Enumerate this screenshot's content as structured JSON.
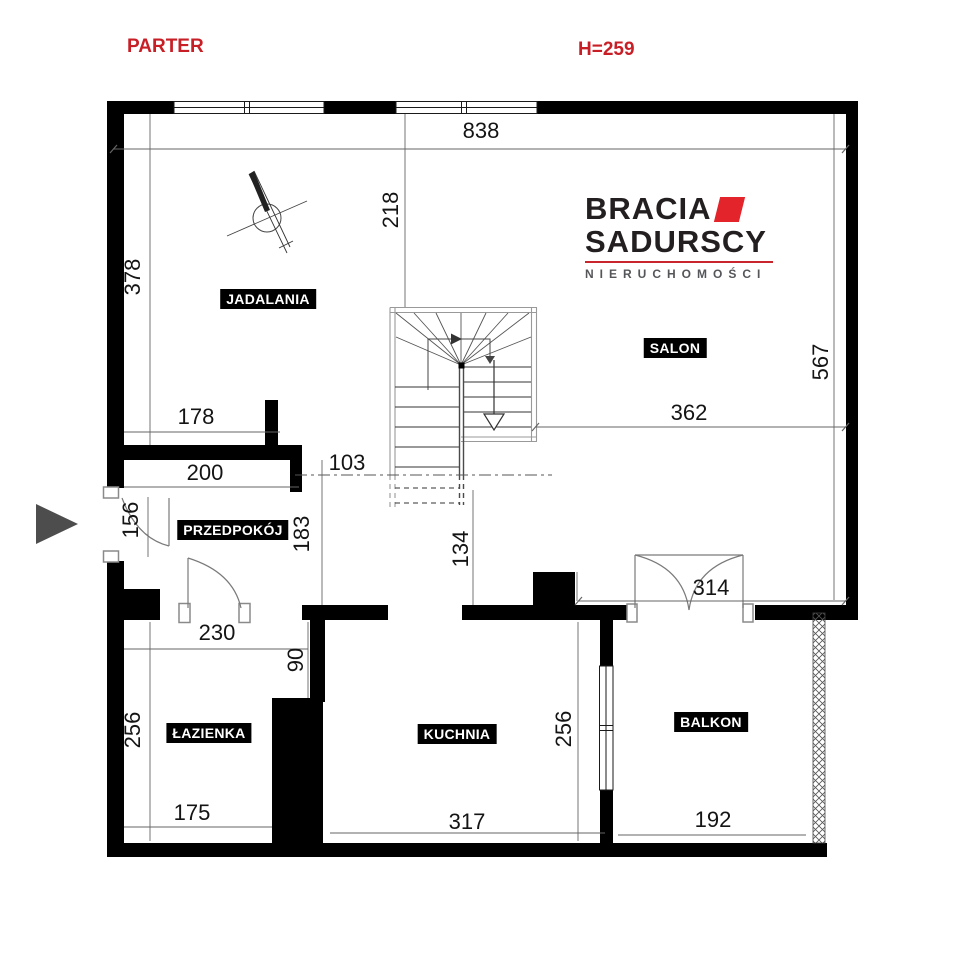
{
  "page": {
    "title": "PARTER",
    "ceiling_height": "H=259"
  },
  "colors": {
    "accent_red": "#c81f27",
    "logo_red": "#e3242a",
    "wall": "#000000",
    "entrance_arrow_gray": "#4d4d4d"
  },
  "logo": {
    "line1": "BRACIA",
    "line2": "SADURSCY",
    "line3": "NIERUCHOMOŚCI"
  },
  "rooms": {
    "dining": "JADALANIA",
    "living": "SALON",
    "hall": "PRZEDPOKÓJ",
    "bath": "ŁAZIENKA",
    "kitchen": "KUCHNIA",
    "balcony": "BALKON"
  },
  "dimensions": {
    "top_width": "838",
    "dining_to_stairs": "218",
    "dining_height": "378",
    "hall_upper_width": "178",
    "hall_width": "200",
    "stairs_gap": "103",
    "entry_door": "156",
    "hall_height": "183",
    "stairs_to_kitchen": "134",
    "salon_width": "362",
    "salon_height": "567",
    "balcony_door": "314",
    "bath_top_width": "230",
    "bath_niche": "90",
    "bath_height": "256",
    "bath_bottom_width": "175",
    "kitchen_width": "317",
    "kitchen_height": "256",
    "balcony_width": "192"
  }
}
